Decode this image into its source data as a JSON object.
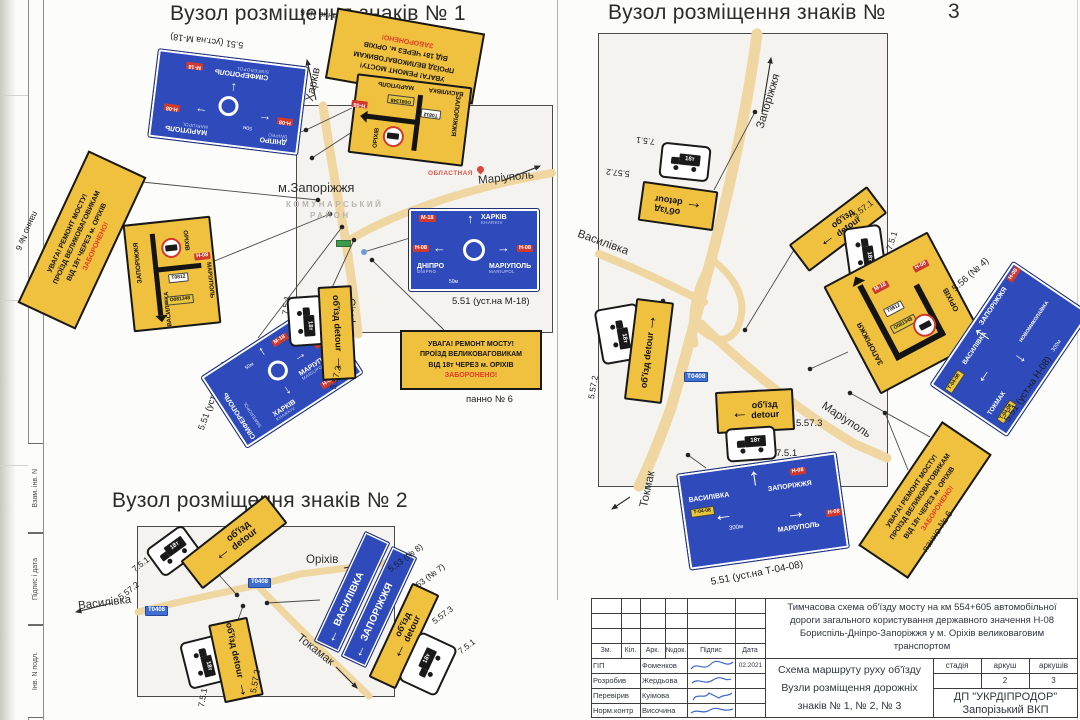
{
  "sheet": {
    "side_labels": [
      "Взам. інв. N",
      "Підпис і дата",
      "Інв. N подл."
    ]
  },
  "common": {
    "detour_ua": "об'їзд",
    "detour_en": "detour",
    "truck_weight": "18т",
    "warning_lines": [
      "УВАГА! РЕМОНТ МОСТУ!",
      "ПРОЇЗД ВЕЛИКОВАГОВИКАМ",
      "ВІД 18т ЧЕРЕЗ м. ОРІХІВ",
      "ЗАБОРОНЕНО!"
    ],
    "panno": "панно № 6",
    "dist50": "50м",
    "dist300": "300м",
    "badge_m18": "М-18",
    "badge_n08": "Н-08",
    "badge_t0408": "Т-04-08",
    "badge_t0812": "Т0812",
    "badge_o081348": "О081348",
    "road_badge": "Т0408"
  },
  "cities": {
    "zaporizhzhia": "ЗАПОРІЖЖЯ",
    "orikhiv": "ОРІХІВ",
    "vasylivka": "ВАСИЛІВКА",
    "mariupol": "МАРІУПОЛЬ",
    "mariupol_en": "MARIUPOL",
    "simferopol": "СІМФЕРОПОЛЬ",
    "simferopol_en": "SIMFEROPOL",
    "kharkiv": "ХАРКІВ",
    "kharkiv_en": "KHARKIV",
    "dnipro": "ДНІПРО",
    "dnipro_en": "DNIPRO",
    "tokmak": "ТОКМАК",
    "novomykolaivka": "НОВОМИКОЛАЇВКА"
  },
  "codes": {
    "c751": "7.5.1",
    "c5571": "5.57.1",
    "c5572": "5.57.2",
    "c5573": "5.57.3",
    "c551m18": "5.51 (уст.на М-18)",
    "c551n08": "5.51 (уст.на Н-08)",
    "c551t": "5.51 (уст.на Т-04-08)",
    "c5537": "5.53 (№ 7)",
    "c5538": "5.53 (№ 8)",
    "c5561": "5.56 (№1)",
    "c5564": "5.56 (№ 4)",
    "c5565": "5.56 (№5)"
  },
  "node1": {
    "title": "Вузол розміщення знаків № 1",
    "city": "м.Запоріжжя",
    "district1": "КОМУНАРСЬКИЙ",
    "district2": "РАЙОН",
    "oblast": "ОБЛАСТНАЯ",
    "road_kharkiv": "Харків",
    "road_mariupol": "Маріуполь",
    "road_simferopol": "Сімферополь"
  },
  "node2": {
    "title": "Вузол розміщення знаків № 2",
    "road_orikhiv": "Оріхів",
    "road_vasylivka": "Василівка",
    "road_tokamak": "Токамак"
  },
  "node3": {
    "title": "Вузол розміщення знаків №",
    "title_num": "3",
    "road_zaporizhzhia": "Запоріжжя",
    "road_vasylivka": "Василівка",
    "road_mariupol": "Маріуполь",
    "road_tokmak": "Токмак"
  },
  "titleblock": {
    "description": "Тимчасова схема об'їзду мосту на км 554+605 автомобільної дороги загального користування державного значення Н-08 Бориспіль-Дніпро-Запоріжжя у м. Оріхів великоваговим транспортом",
    "scheme1": "Схема маршруту руху об'їзду",
    "scheme2": "Вузли розміщення дорожніх",
    "scheme3": "знаків № 1, № 2, № 3",
    "org1": "ДП \"УКРДІПРОДОР\"",
    "org2": "Запорізький ВКП",
    "col_zm": "Зм.",
    "col_kil": "Кіл.",
    "col_ark": "Арк.",
    "col_ndok": "№док.",
    "col_pidpys": "Підпис",
    "col_data": "Дата",
    "stage": "стадія",
    "sheet": "аркуш",
    "sheets": "аркушів",
    "sheet_no": "2",
    "sheets_total": "3",
    "rows": [
      {
        "role": "ГІП",
        "name": "Фоменков",
        "date": "02.2021"
      },
      {
        "role": "Розробив",
        "name": "Жердьова",
        "date": ""
      },
      {
        "role": "Перевірив",
        "name": "Куімова",
        "date": ""
      },
      {
        "role": "Норм.контр",
        "name": "Височина",
        "date": ""
      }
    ]
  }
}
